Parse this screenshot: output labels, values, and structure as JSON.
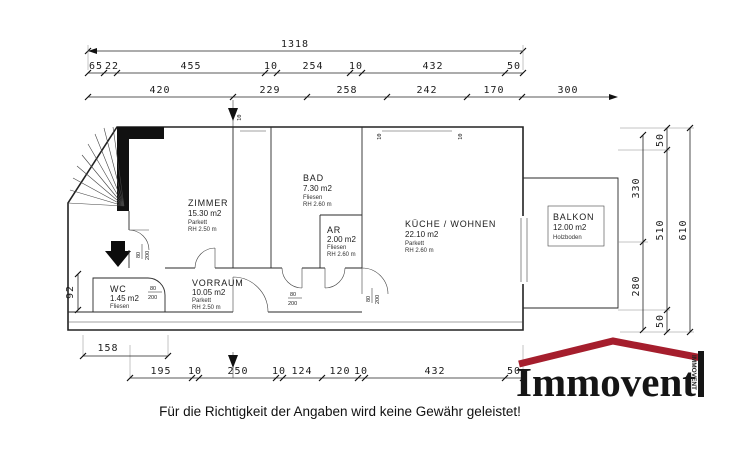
{
  "disclaimer": "Für die Richtigkeit der Angaben wird keine Gewähr geleistet!",
  "logo": {
    "brand": "Immovent",
    "chimney": "IMMOVENT",
    "roof_color": "#a51e2d"
  },
  "dims": {
    "total": "1318",
    "row2": [
      "65",
      "22",
      "455",
      "10",
      "254",
      "10",
      "432",
      "50"
    ],
    "row3": [
      "420",
      "229",
      "258",
      "242",
      "170",
      "300"
    ],
    "bottom": [
      "195",
      "10",
      "250",
      "10",
      "124",
      "120",
      "10",
      "432",
      "50"
    ],
    "offset": "158",
    "left": "92",
    "right_inner": [
      "330",
      "280"
    ],
    "right_mid": [
      "50",
      "510",
      "50"
    ],
    "right_outer": "610",
    "wall_marks": [
      "10",
      "10",
      "10"
    ],
    "door_w": "80",
    "door_h": "200"
  },
  "rooms": {
    "zimmer": {
      "name": "ZIMMER",
      "area": "15.30 m2",
      "floor": "Parkett",
      "height": "RH 2.50 m"
    },
    "bad": {
      "name": "BAD",
      "area": "7.30 m2",
      "floor": "Fliesen",
      "height": "RH 2.60 m"
    },
    "ar": {
      "name": "AR",
      "area": "2.00 m2",
      "floor": "Fliesen",
      "height": "RH 2.60 m"
    },
    "kueche": {
      "name": "KÜCHE / WOHNEN",
      "area": "22.10 m2",
      "floor": "Parkett",
      "height": "RH 2.60 m"
    },
    "balkon": {
      "name": "BALKON",
      "area": "12.00 m2",
      "floor": "Holzboden"
    },
    "vorraum": {
      "name": "VORRAUM",
      "area": "10.05 m2",
      "floor": "Parkett",
      "height": "RH 2.50 m"
    },
    "wc": {
      "name": "WC",
      "area": "1.45 m2",
      "floor": "Fliesen"
    }
  }
}
